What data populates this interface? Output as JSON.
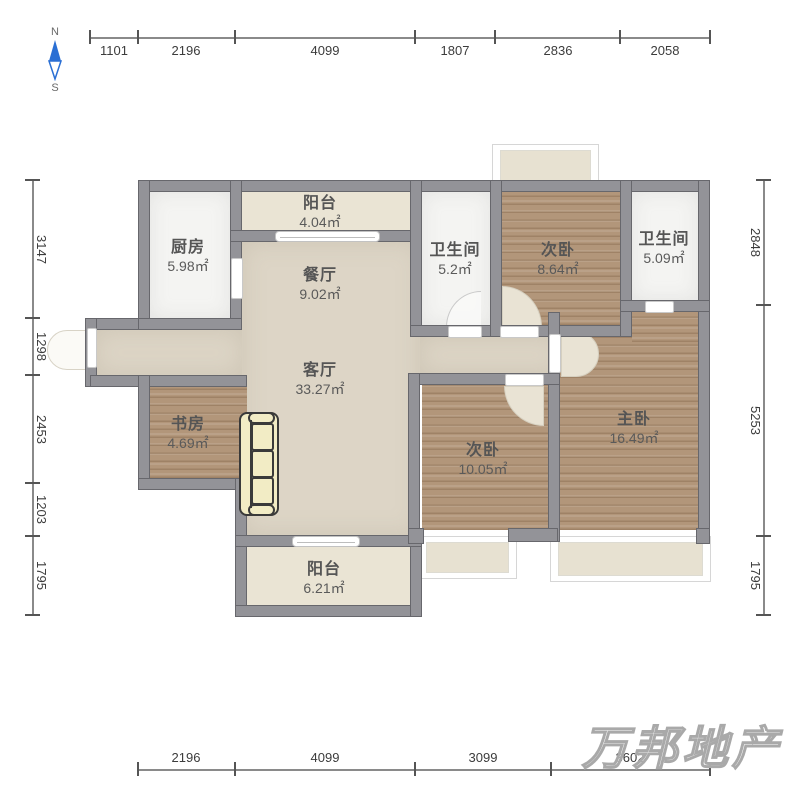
{
  "compass": {
    "north_label": "N",
    "south_label": "S"
  },
  "watermark": "万邦地产",
  "dimensions": {
    "top": [
      "1101",
      "2196",
      "4099",
      "1807",
      "2836",
      "2058"
    ],
    "left": [
      "3147",
      "1298",
      "2453",
      "1203",
      "1795"
    ],
    "right": [
      "2848",
      "5253",
      "1795"
    ],
    "bottom": [
      "2196",
      "4099",
      "3099",
      "3602"
    ]
  },
  "rooms": [
    {
      "name": "厨房",
      "area": "5.98㎡"
    },
    {
      "name": "阳台",
      "area": "4.04㎡"
    },
    {
      "name": "餐厅",
      "area": "9.02㎡"
    },
    {
      "name": "卫生间",
      "area": "5.2㎡"
    },
    {
      "name": "次卧",
      "area": "8.64㎡"
    },
    {
      "name": "卫生间",
      "area": "5.09㎡"
    },
    {
      "name": "客厅",
      "area": "33.27㎡"
    },
    {
      "name": "书房",
      "area": "4.69㎡"
    },
    {
      "name": "次卧",
      "area": "10.05㎡"
    },
    {
      "name": "主卧",
      "area": "16.49㎡"
    },
    {
      "name": "阳台",
      "area": "6.21㎡"
    }
  ],
  "colors": {
    "wall": "#939398",
    "floor_wood": "#b2967a",
    "floor_beige": "#ddd5c6",
    "floor_cream": "#eae4d4",
    "floor_light": "#f4f4f2",
    "compass_blue": "#2a6fd4",
    "dimension_text": "#3c3c3c",
    "room_label_text": "#555555",
    "watermark_gray": "#a9a9a9"
  }
}
